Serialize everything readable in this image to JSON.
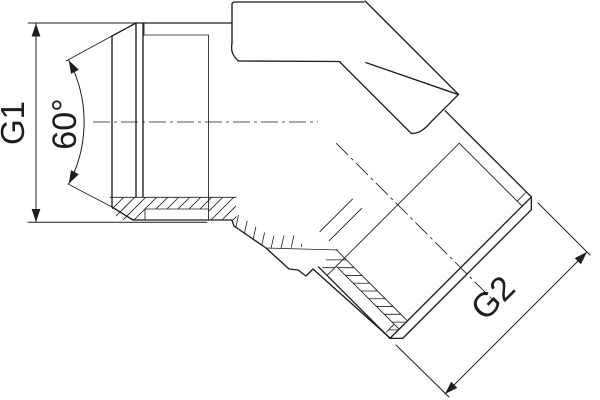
{
  "drawing": {
    "labels": {
      "g1": "G1",
      "angle": "60°",
      "g2": "G2"
    },
    "colors": {
      "line": "#1d1d1b",
      "background": "#ffffff"
    }
  }
}
